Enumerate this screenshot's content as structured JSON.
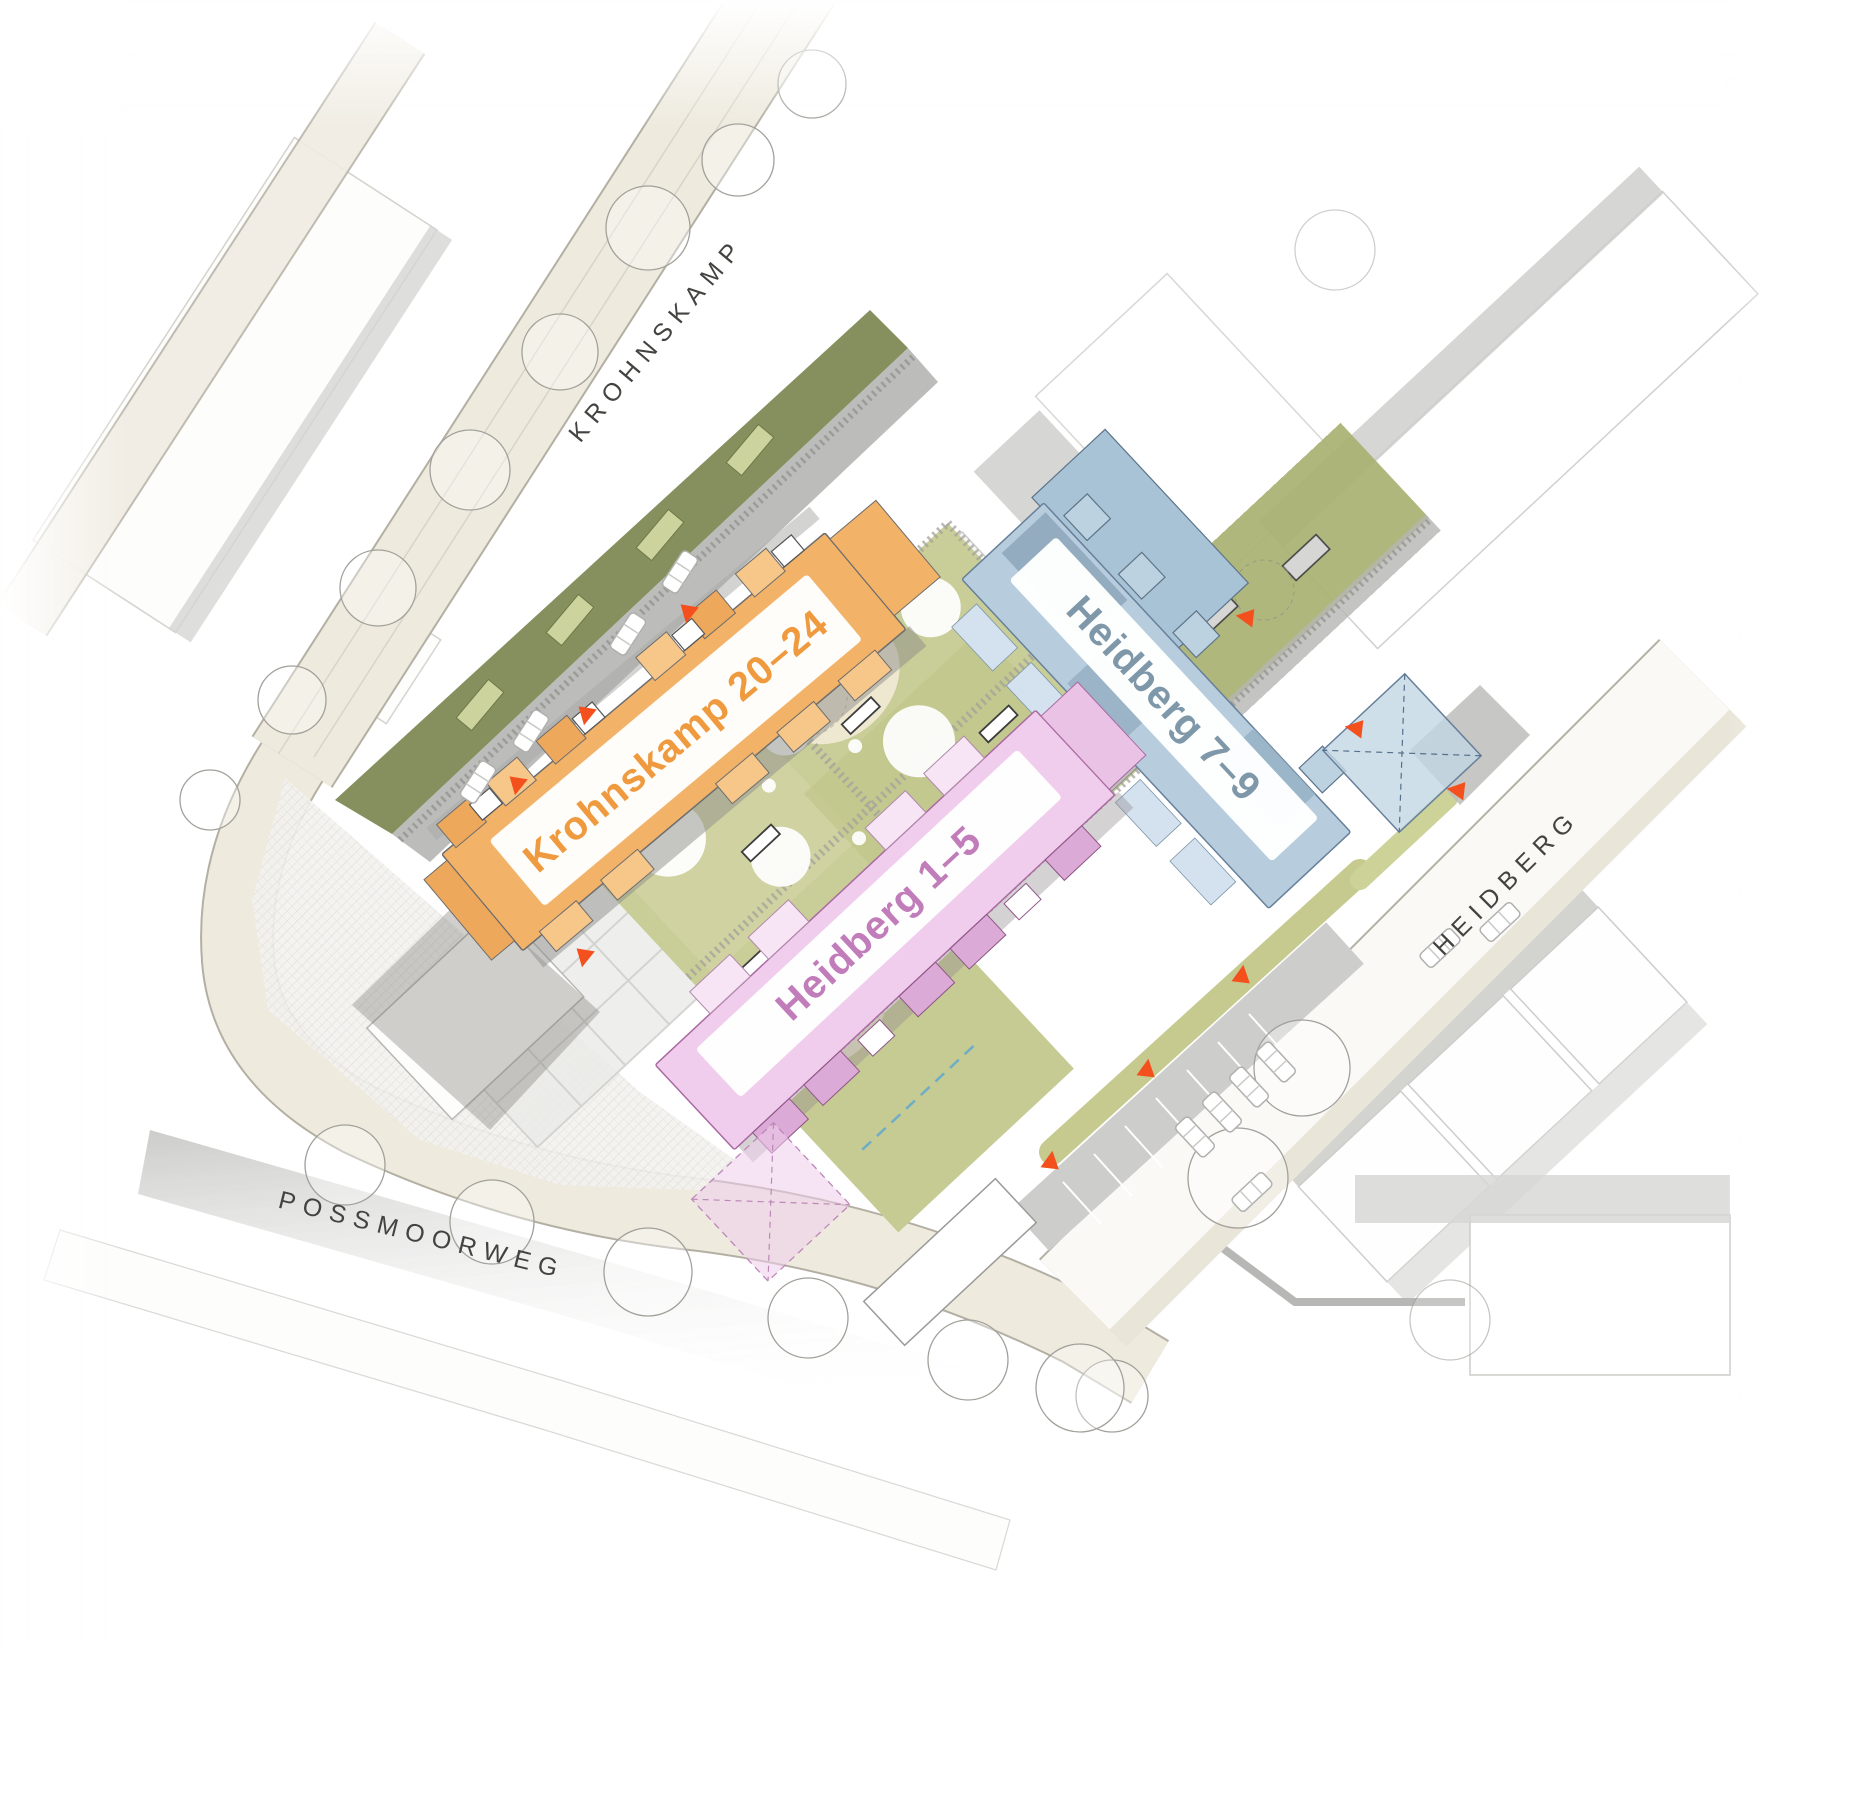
{
  "plan": {
    "type": "architectural-site-plan"
  },
  "streets": [
    {
      "id": "krohnskamp",
      "label": "KROHNSKAMP"
    },
    {
      "id": "heidberg",
      "label": "HEIDBERG"
    },
    {
      "id": "possmoorweg",
      "label": "POSSMOORWEG"
    }
  ],
  "buildings": [
    {
      "id": "krohnskamp-20-24",
      "label": "Krohnskamp 20–24",
      "fill": "#f2b369",
      "accent": "#eda85b",
      "light": "#f7c689",
      "label_color": "#ef9a3e"
    },
    {
      "id": "heidberg-7-9",
      "label": "Heidberg 7–9",
      "fill": "#b7cdde",
      "accent": "#8fa9bd",
      "light": "#d3e2ee",
      "label_color": "#7e97a9"
    },
    {
      "id": "heidberg-1-5",
      "label": "Heidberg 1–5",
      "fill": "#f0cdec",
      "accent": "#dcaad6",
      "light": "#f7e4f4",
      "label_color": "#c17cba"
    }
  ],
  "markers": {
    "entrance_color": "#f4501e"
  },
  "colors": {
    "street_fill": "#eeeade",
    "street_border": "#b3afa3",
    "courtyard_green": "#c9cd97",
    "roof_green": "#a9b172",
    "garden_strip": "#7f8a55",
    "context_gray": "#c9c9c7"
  }
}
